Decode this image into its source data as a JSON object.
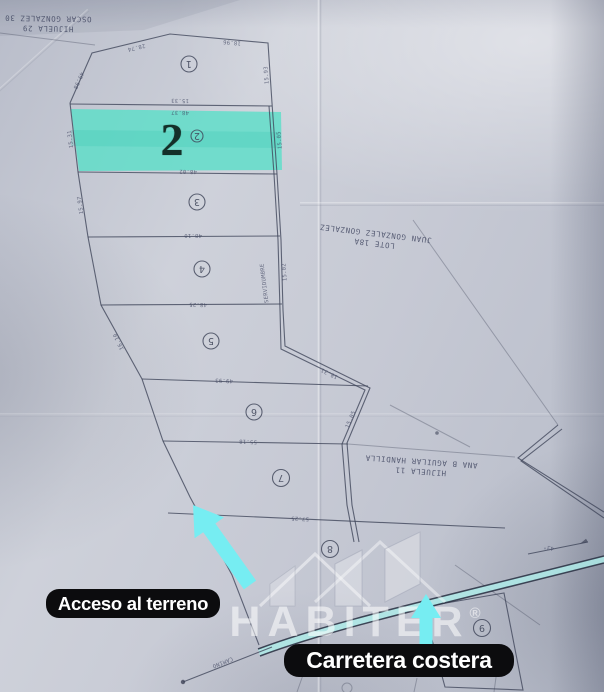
{
  "colors": {
    "paper": "#c4c7d2",
    "ink": "#3e4458",
    "teal": "#57dfc8",
    "cyan": "#76edf2",
    "road_fill": "#aeeae8",
    "pill_bg": "#0c0c0e",
    "pill_text": "#ffffff",
    "num_ink": "#143029",
    "wm": "#ffffff"
  },
  "annotations": {
    "access_label": "Acceso al terreno",
    "road_label": "Carretera costera"
  },
  "watermark": {
    "brand": "HABITER",
    "registered": "®",
    "tagline": "Oriente"
  },
  "highlight": {
    "lot_number": "2"
  },
  "plan": {
    "lot_markers": [
      {
        "n": "1",
        "x": 189,
        "y": 64,
        "r": 8
      },
      {
        "n": "2",
        "x": 197,
        "y": 136,
        "r": 6
      },
      {
        "n": "3",
        "x": 197,
        "y": 202,
        "r": 8
      },
      {
        "n": "4",
        "x": 202,
        "y": 269,
        "r": 8
      },
      {
        "n": "5",
        "x": 211,
        "y": 341,
        "r": 8
      },
      {
        "n": "6",
        "x": 254,
        "y": 412,
        "r": 8
      },
      {
        "n": "7",
        "x": 281,
        "y": 478,
        "r": 8.5
      },
      {
        "n": "8",
        "x": 330,
        "y": 549,
        "r": 8.5
      },
      {
        "n": "9",
        "x": 482,
        "y": 628,
        "r": 8.5
      }
    ],
    "neighbor_labels": [
      {
        "id": "hijuela-29",
        "lines": [
          "HIJUELA 29",
          "OSCAR GONZALEZ 30"
        ],
        "x": 48,
        "y": 23,
        "r": 181
      },
      {
        "id": "lote-18a",
        "lines": [
          "LOTE 18A",
          "JUAN GONZALEZ GONZALEZ"
        ],
        "x": 375,
        "y": 238,
        "r": 187
      },
      {
        "id": "hijuela-11",
        "lines": [
          "HIJUELA 11",
          "ANA B AGUILAR HANDILLA"
        ],
        "x": 421,
        "y": 466,
        "r": 184
      }
    ],
    "measurements": [
      {
        "t": "28.74",
        "x": 136,
        "y": 46,
        "r": 166
      },
      {
        "t": "18.96",
        "x": 232,
        "y": 41,
        "r": 185
      },
      {
        "t": "49.98",
        "x": 77,
        "y": 80,
        "r": 114
      },
      {
        "t": "15.93",
        "x": 268,
        "y": 75,
        "r": 266
      },
      {
        "t": "15.33",
        "x": 180,
        "y": 99,
        "r": 181
      },
      {
        "t": "48.37",
        "x": 180,
        "y": 111,
        "r": 181
      },
      {
        "t": "48.02",
        "x": 188,
        "y": 170,
        "r": 181
      },
      {
        "t": "15.31",
        "x": 72,
        "y": 139,
        "r": 263
      },
      {
        "t": "15.05",
        "x": 281,
        "y": 140,
        "r": 265
      },
      {
        "t": "48.10",
        "x": 193,
        "y": 234,
        "r": 180
      },
      {
        "t": "15.97",
        "x": 82,
        "y": 205,
        "r": 262
      },
      {
        "t": "48.25",
        "x": 198,
        "y": 303,
        "r": 181
      },
      {
        "t": "15.02",
        "x": 286,
        "y": 272,
        "r": 266
      },
      {
        "t": "SERVIDUMBRE",
        "x": 266,
        "y": 283,
        "r": 263
      },
      {
        "t": "49.93",
        "x": 224,
        "y": 379,
        "r": 182
      },
      {
        "t": "16.10",
        "x": 120,
        "y": 341,
        "r": 245
      },
      {
        "t": "55.18",
        "x": 248,
        "y": 440,
        "r": 182
      },
      {
        "t": "18.31",
        "x": 330,
        "y": 372,
        "r": 206
      },
      {
        "t": "15.05",
        "x": 352,
        "y": 420,
        "r": 293
      },
      {
        "t": "57.25",
        "x": 300,
        "y": 517,
        "r": 182
      },
      {
        "t": "43°",
        "x": 549,
        "y": 546,
        "r": 192
      },
      {
        "t": "15.08",
        "x": 427,
        "y": 668,
        "r": 262
      },
      {
        "t": "CAMINO",
        "x": 222,
        "y": 661,
        "r": 158
      }
    ]
  }
}
